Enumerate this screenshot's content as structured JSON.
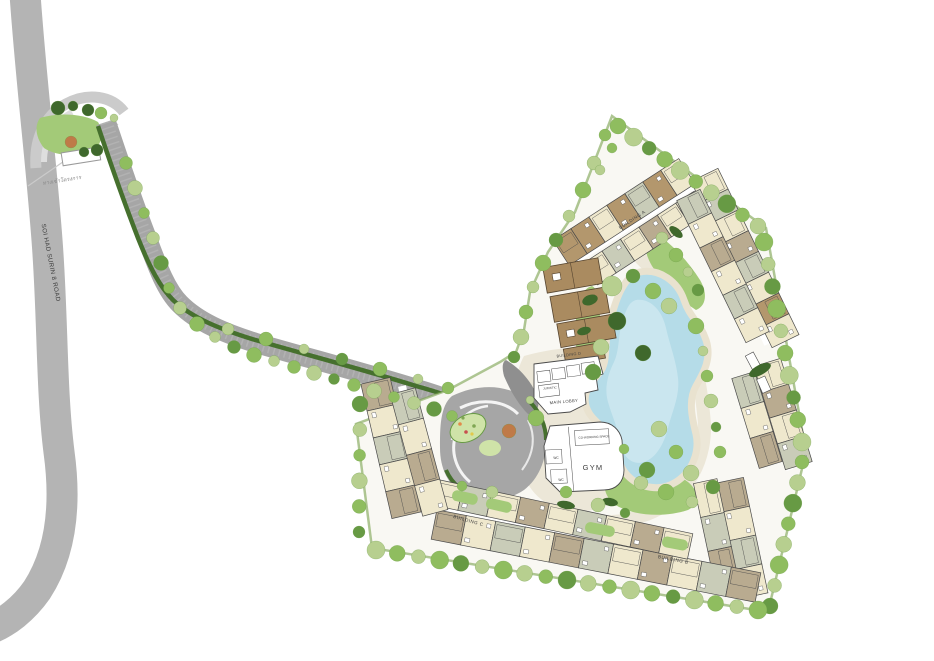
{
  "plan": {
    "road_label": "SOI HAD SURIN 8 ROAD",
    "entrance_label": "ทางเข้าโครงการ",
    "buildings": {
      "a": "BUILDING A",
      "b": "BUILDING B",
      "c": "BUILDING C",
      "d": "BUILDING D"
    },
    "amenities": {
      "main_lobby": "MAIN LOBBY",
      "juristic": "JURISTIC",
      "coworking": "CO-WORKING SPACE",
      "wc": "WC",
      "gym": "GYM"
    }
  },
  "colors": {
    "road": "#b4b4b4",
    "road_light": "#cbcbcb",
    "road_lighter": "#dedede",
    "driveway": "#a6a6a6",
    "driveway_hi": "#bcbcbc",
    "driveway_dark": "#8f8f8f",
    "hedge": "#46702e",
    "perimeter": "#7aa14e",
    "site": "#f9f8f3",
    "path": "#ece7d8",
    "lawn": "#a3ca78",
    "lawn_light": "#cfe3a8",
    "tree_light": "#b7cf8f",
    "tree_mid": "#8fbd5f",
    "tree_dark": "#679a44",
    "tree_deep": "#3f682c",
    "orange_tree": "#bf7a48",
    "topiary": "#d6de96",
    "topiary_dark": "#aeb86a",
    "lake": "#b5dce8",
    "lake_light": "#d2eaf1",
    "sand": "#e9e2cf",
    "bld_tan": "#b3976d",
    "bld_cream": "#efe8cd",
    "bld_sage": "#c9ccb8",
    "bld_taupe": "#b9ab90",
    "bld_brown": "#aa8b60",
    "outline": "#4a4a4a",
    "white": "#ffffff",
    "sign_border": "#9a9a9a",
    "text": "#3f3f3f",
    "text_muted": "#8a8a8a"
  }
}
